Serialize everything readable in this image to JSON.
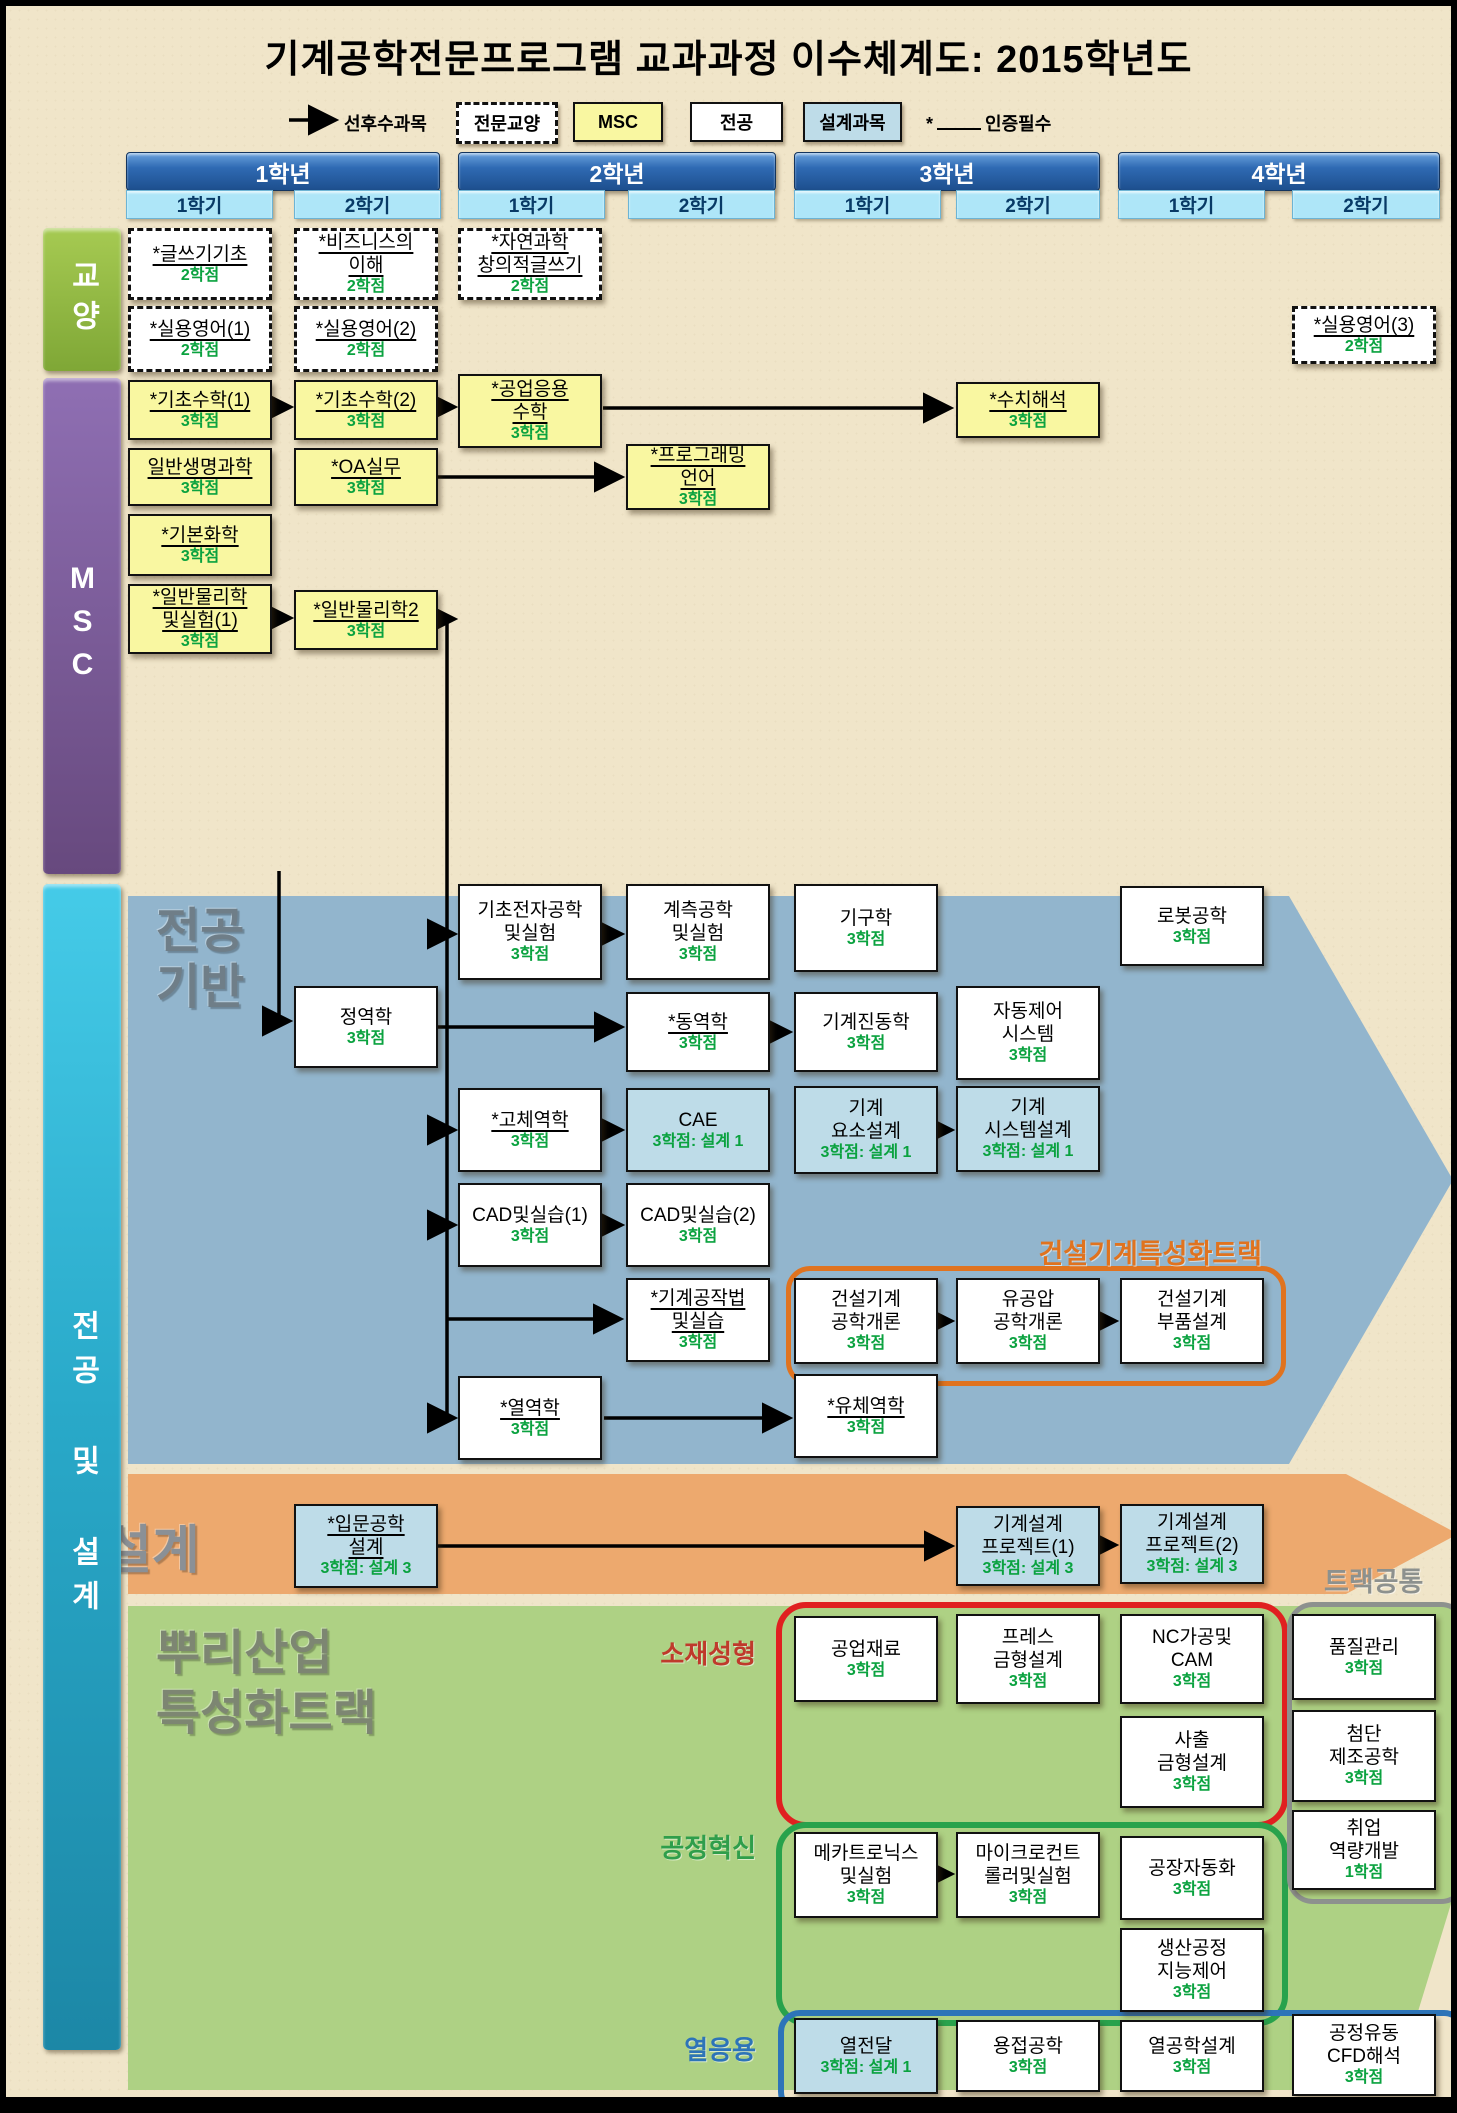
{
  "title": "기계공학전문프로그램 교과과정 이수체계도: 2015학년도",
  "legend": {
    "arrow_label": "선후수과목",
    "general_label": "전문교양",
    "msc_label": "MSC",
    "major_label": "전공",
    "design_label": "설계과목",
    "required_star": "*",
    "required_note": "인증필수"
  },
  "years": [
    {
      "label": "1학년",
      "semesters": [
        "1학기",
        "2학기"
      ]
    },
    {
      "label": "2학년",
      "semesters": [
        "1학기",
        "2학기"
      ]
    },
    {
      "label": "3학년",
      "semesters": [
        "1학기",
        "2학기"
      ]
    },
    {
      "label": "4학년",
      "semesters": [
        "1학기",
        "2학기"
      ]
    }
  ],
  "sidebars": {
    "general": "교양",
    "msc": "MSC",
    "major_design": "전공 및 설계"
  },
  "sections": {
    "major_base": "전공\n기반",
    "design_band": "설계",
    "root_industry": "뿌리산업\n특성화트랙"
  },
  "group_labels": {
    "construction": "건설기계특성화트랙",
    "track_common": "트랙공통",
    "materials": "소재성형",
    "process": "공정혁신",
    "thermal": "열응용"
  },
  "colors": {
    "background": "#f0e5c9",
    "major_base_region": "#92b5cd",
    "design_band_region": "#eda96e",
    "root_region": "#aed184",
    "msc_box": "#f9f7a1",
    "design_box": "#bedce8",
    "credit_green": "#0aa23f",
    "construction_outline": "#e0731f",
    "materials_outline": "#e02020",
    "process_outline": "#28a24c",
    "thermal_outline": "#2d74b8",
    "track_common_outline": "#8d918e"
  },
  "courses": [
    {
      "n": [
        "*글쓰기기초"
      ],
      "c": "2학점",
      "t": "ge",
      "col": 0,
      "y": 222,
      "h": 72,
      "u": 1
    },
    {
      "n": [
        "*비즈니스의",
        "이해"
      ],
      "c": "2학점",
      "t": "ge",
      "col": 1,
      "y": 222,
      "h": 72,
      "u": 1
    },
    {
      "n": [
        "*자연과학",
        "창의적글쓰기"
      ],
      "c": "2학점",
      "t": "ge",
      "col": 2,
      "y": 222,
      "h": 72,
      "u": 1
    },
    {
      "n": [
        "*실용영어(1)"
      ],
      "c": "2학점",
      "t": "ge",
      "col": 0,
      "y": 300,
      "h": 66,
      "u": 1
    },
    {
      "n": [
        "*실용영어(2)"
      ],
      "c": "2학점",
      "t": "ge",
      "col": 1,
      "y": 300,
      "h": 66,
      "u": 1
    },
    {
      "n": [
        "*실용영어(3)"
      ],
      "c": "2학점",
      "t": "ge",
      "col": 7,
      "y": 300,
      "h": 58,
      "u": 1
    },
    {
      "n": [
        "*기초수학(1)"
      ],
      "c": "3학점",
      "t": "msc",
      "col": 0,
      "y": 374,
      "h": 60,
      "u": 1
    },
    {
      "n": [
        "*기초수학(2)"
      ],
      "c": "3학점",
      "t": "msc",
      "col": 1,
      "y": 374,
      "h": 60,
      "u": 1
    },
    {
      "n": [
        "*공업응용",
        "수학"
      ],
      "c": "3학점",
      "t": "msc",
      "col": 2,
      "y": 368,
      "h": 74,
      "u": 1
    },
    {
      "n": [
        "*수치해석"
      ],
      "c": "3학점",
      "t": "msc",
      "col": 5,
      "y": 376,
      "h": 56,
      "u": 1
    },
    {
      "n": [
        "일반생명과학"
      ],
      "c": "3학점",
      "t": "msc",
      "col": 0,
      "y": 442,
      "h": 58,
      "u": 1
    },
    {
      "n": [
        "*OA실무"
      ],
      "c": "3학점",
      "t": "msc",
      "col": 1,
      "y": 442,
      "h": 58,
      "u": 1
    },
    {
      "n": [
        "*프로그래밍",
        "언어"
      ],
      "c": "3학점",
      "t": "msc",
      "col": 3,
      "y": 438,
      "h": 66,
      "u": 1
    },
    {
      "n": [
        "*기본화학"
      ],
      "c": "3학점",
      "t": "msc",
      "col": 0,
      "y": 508,
      "h": 62,
      "u": 1
    },
    {
      "n": [
        "*일반물리학",
        "및실험(1)"
      ],
      "c": "3학점",
      "t": "msc",
      "col": 0,
      "y": 578,
      "h": 70,
      "u": 1
    },
    {
      "n": [
        "*일반물리학2"
      ],
      "c": "3학점",
      "t": "msc",
      "col": 1,
      "y": 584,
      "h": 60,
      "u": 1
    },
    {
      "n": [
        "기초전자공학",
        "및실험"
      ],
      "c": "3학점",
      "t": "major",
      "col": 2,
      "y": 878,
      "h": 96
    },
    {
      "n": [
        "계측공학",
        "및실험"
      ],
      "c": "3학점",
      "t": "major",
      "col": 3,
      "y": 878,
      "h": 96
    },
    {
      "n": [
        "기구학"
      ],
      "c": "3학점",
      "t": "major",
      "col": 4,
      "y": 878,
      "h": 88
    },
    {
      "n": [
        "로봇공학"
      ],
      "c": "3학점",
      "t": "major",
      "col": 6,
      "y": 880,
      "h": 80
    },
    {
      "n": [
        "정역학"
      ],
      "c": "3학점",
      "t": "major",
      "col": 1,
      "y": 980,
      "h": 82
    },
    {
      "n": [
        "*동역학"
      ],
      "c": "3학점",
      "t": "major",
      "col": 3,
      "y": 986,
      "h": 80,
      "u": 1
    },
    {
      "n": [
        "기계진동학"
      ],
      "c": "3학점",
      "t": "major",
      "col": 4,
      "y": 986,
      "h": 80
    },
    {
      "n": [
        "자동제어",
        "시스템"
      ],
      "c": "3학점",
      "t": "major",
      "col": 5,
      "y": 980,
      "h": 94
    },
    {
      "n": [
        "*고체역학"
      ],
      "c": "3학점",
      "t": "major",
      "col": 2,
      "y": 1082,
      "h": 84,
      "u": 1
    },
    {
      "n": [
        "CAE"
      ],
      "c": "3학점: 설계 1",
      "t": "design",
      "col": 3,
      "y": 1082,
      "h": 84
    },
    {
      "n": [
        "기계",
        "요소설계"
      ],
      "c": "3학점: 설계 1",
      "t": "design",
      "col": 4,
      "y": 1080,
      "h": 88
    },
    {
      "n": [
        "기계",
        "시스템설계"
      ],
      "c": "3학점: 설계 1",
      "t": "design",
      "col": 5,
      "y": 1080,
      "h": 86
    },
    {
      "n": [
        "CAD및실습(1)"
      ],
      "c": "3학점",
      "t": "major",
      "col": 2,
      "y": 1177,
      "h": 84
    },
    {
      "n": [
        "CAD및실습(2)"
      ],
      "c": "3학점",
      "t": "major",
      "col": 3,
      "y": 1177,
      "h": 84
    },
    {
      "n": [
        "*기계공작법",
        "및실습"
      ],
      "c": "3학점",
      "t": "major",
      "col": 3,
      "y": 1272,
      "h": 84,
      "u": 1
    },
    {
      "n": [
        "건설기계",
        "공학개론"
      ],
      "c": "3학점",
      "t": "major",
      "col": 4,
      "y": 1272,
      "h": 86
    },
    {
      "n": [
        "유공압",
        "공학개론"
      ],
      "c": "3학점",
      "t": "major",
      "col": 5,
      "y": 1272,
      "h": 86
    },
    {
      "n": [
        "건설기계",
        "부품설계"
      ],
      "c": "3학점",
      "t": "major",
      "col": 6,
      "y": 1272,
      "h": 86
    },
    {
      "n": [
        "*열역학"
      ],
      "c": "3학점",
      "t": "major",
      "col": 2,
      "y": 1370,
      "h": 84,
      "u": 1
    },
    {
      "n": [
        "*유체역학"
      ],
      "c": "3학점",
      "t": "major",
      "col": 4,
      "y": 1368,
      "h": 84,
      "u": 1
    },
    {
      "n": [
        "*입문공학",
        "설계"
      ],
      "c": "3학점: 설계 3",
      "t": "design",
      "col": 1,
      "y": 1498,
      "h": 84,
      "u": 1
    },
    {
      "n": [
        "기계설계",
        "프로젝트(1)"
      ],
      "c": "3학점: 설계 3",
      "t": "design",
      "col": 5,
      "y": 1500,
      "h": 80
    },
    {
      "n": [
        "기계설계",
        "프로젝트(2)"
      ],
      "c": "3학점: 설계 3",
      "t": "design",
      "col": 6,
      "y": 1498,
      "h": 80
    },
    {
      "n": [
        "공업재료"
      ],
      "c": "3학점",
      "t": "major",
      "col": 4,
      "y": 1610,
      "h": 86
    },
    {
      "n": [
        "프레스",
        "금형설계"
      ],
      "c": "3학점",
      "t": "major",
      "col": 5,
      "y": 1608,
      "h": 90
    },
    {
      "n": [
        "NC가공및",
        "CAM"
      ],
      "c": "3학점",
      "t": "major",
      "col": 6,
      "y": 1608,
      "h": 90
    },
    {
      "n": [
        "사출",
        "금형설계"
      ],
      "c": "3학점",
      "t": "major",
      "col": 6,
      "y": 1710,
      "h": 92
    },
    {
      "n": [
        "품질관리"
      ],
      "c": "3학점",
      "t": "major",
      "col": 7,
      "y": 1608,
      "h": 86
    },
    {
      "n": [
        "첨단",
        "제조공학"
      ],
      "c": "3학점",
      "t": "major",
      "col": 7,
      "y": 1704,
      "h": 92
    },
    {
      "n": [
        "취업",
        "역량개발"
      ],
      "c": "1학점",
      "t": "major",
      "col": 7,
      "y": 1804,
      "h": 80
    },
    {
      "n": [
        "메카트로닉스",
        "및실험"
      ],
      "c": "3학점",
      "t": "major",
      "col": 4,
      "y": 1826,
      "h": 86
    },
    {
      "n": [
        "마이크로컨트",
        "롤러및실험"
      ],
      "c": "3학점",
      "t": "major",
      "col": 5,
      "y": 1826,
      "h": 86
    },
    {
      "n": [
        "공장자동화"
      ],
      "c": "3학점",
      "t": "major",
      "col": 6,
      "y": 1830,
      "h": 84
    },
    {
      "n": [
        "생산공정",
        "지능제어"
      ],
      "c": "3학점",
      "t": "major",
      "col": 6,
      "y": 1922,
      "h": 84
    },
    {
      "n": [
        "열전달"
      ],
      "c": "3학점: 설계 1",
      "t": "design",
      "col": 4,
      "y": 2012,
      "h": 76
    },
    {
      "n": [
        "용접공학"
      ],
      "c": "3학점",
      "t": "major",
      "col": 5,
      "y": 2014,
      "h": 72
    },
    {
      "n": [
        "열공학설계"
      ],
      "c": "3학점",
      "t": "major",
      "col": 6,
      "y": 2014,
      "h": 72
    },
    {
      "n": [
        "공정유동",
        "CFD해석"
      ],
      "c": "3학점",
      "t": "major",
      "col": 7,
      "y": 2008,
      "h": 82
    }
  ]
}
